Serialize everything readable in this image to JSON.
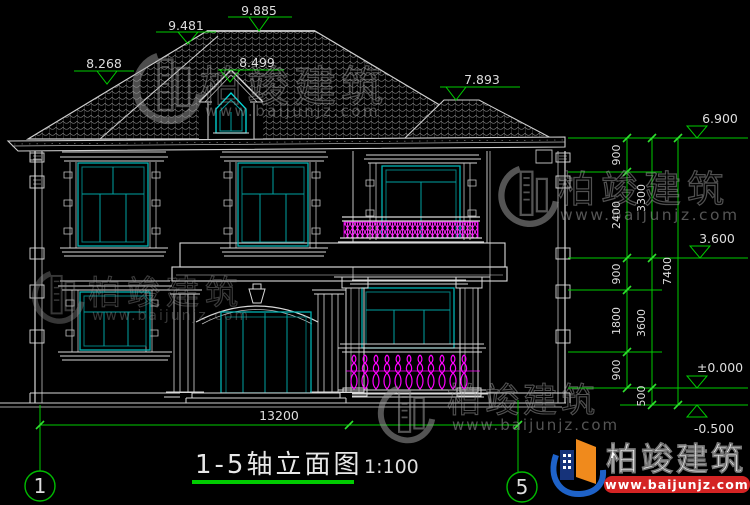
{
  "drawing": {
    "title": "1-5轴立面图",
    "scale": "1:100",
    "overall_width_dim": "13200",
    "axis_left": "1",
    "axis_right": "5"
  },
  "elevation_marks": {
    "r9885": "9.885",
    "r9481": "9.481",
    "r8268": "8.268",
    "r8499": "8.499",
    "r7893": "7.893",
    "r6900": "6.900",
    "r3600": "3.600",
    "r0": "±0.000",
    "rm500": "-0.500"
  },
  "dim_chain": {
    "s900a": "900",
    "s2400": "2400",
    "s900b": "900",
    "s1800": "1800",
    "s900c": "900",
    "s3300": "3300",
    "s3600": "3600",
    "s500": "500",
    "s7400": "7400"
  },
  "watermark": {
    "brand": "柏竣建筑",
    "site": "www.baijunjz.com"
  },
  "colors": {
    "background": "#000000",
    "drawing_line": "#d9d9d9",
    "dimension_green": "#00cc00",
    "tick_green": "#2fdf2f",
    "window_cyan": "#00b2b2",
    "railing_magenta": "#ff00ff",
    "watermark_gray": "#949494",
    "logo_blue": "#1e62c8",
    "logo_navy": "#16337a",
    "logo_orange": "#f08a1c",
    "logo_red": "#d42424"
  }
}
